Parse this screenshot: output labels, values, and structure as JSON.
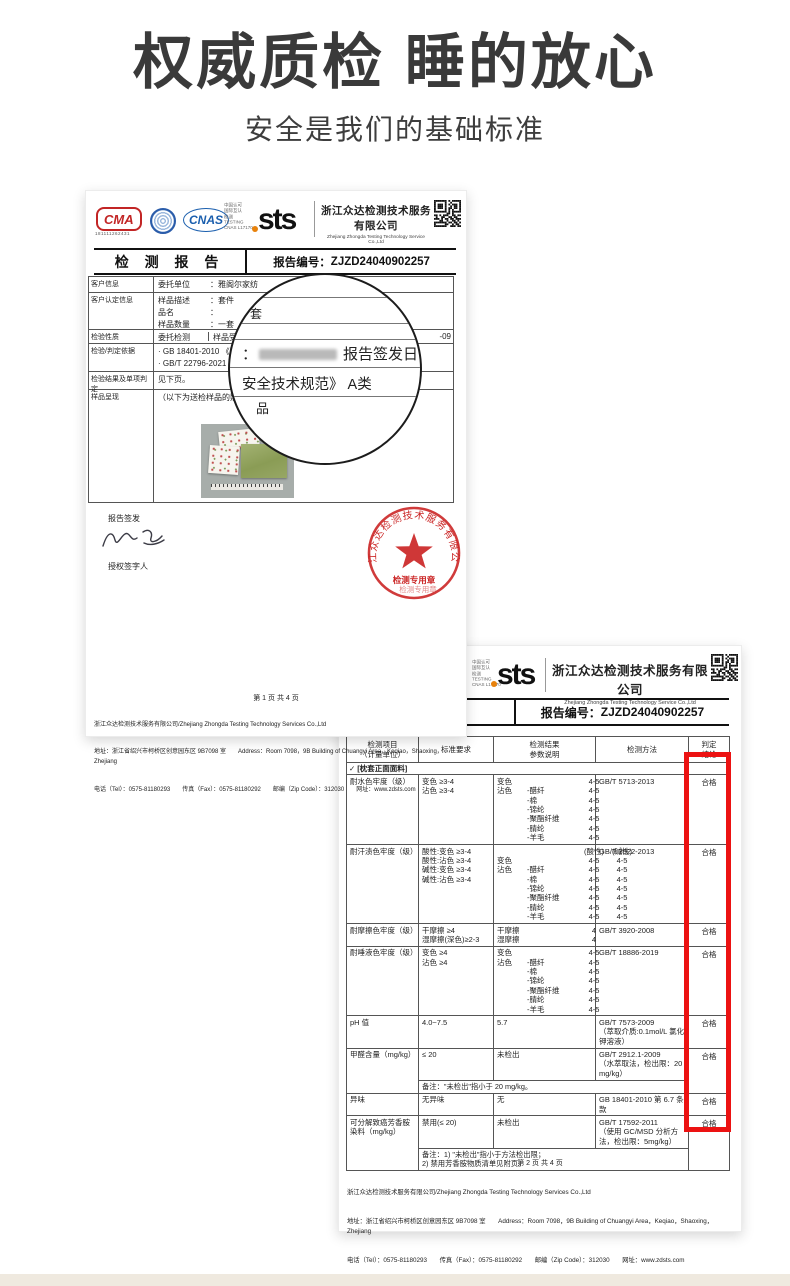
{
  "hero": {
    "title": "权威质检 睡的放心",
    "subtitle": "安全是我们的基础标准"
  },
  "logos": {
    "cma": "CMA",
    "cma_no": "181111262431",
    "ilac": "ilac-MRA",
    "cnas": "CNAS",
    "cnas_small": "中国认可\n国际互认\n检测\nTESTING\nCNAS L17170",
    "sts": "sts"
  },
  "company": {
    "name_cn": "浙江众达检测技术服务有限公司",
    "name_en": "Zhejiang Zhongda Testing Technology Service Co.,Ltd"
  },
  "footer": {
    "company": "浙江众达检测技术服务有限公司/Zhejiang Zhongda Testing Technology Services Co.,Ltd",
    "address": "地址：浙江省绍兴市柯桥区创意园东区 9B7098 室　　Address：Room 7098，9B Building of Chuangyi Area，Keqiao，Shaoxing，Zhejiang",
    "contact": "电话（Tel）：0575-81180293　　传真（Fax）：0575-81180292　　邮编（Zip Code）：312030　　网址：www.zdsts.com"
  },
  "report1": {
    "doc_title": "检 测 报 告",
    "report_no_label": "报告编号：",
    "report_no": "ZJZD24040902257",
    "info_rows": [
      {
        "label": "客户信息",
        "lines": [
          {
            "k": "委托单位",
            "v": "：雅阁尔家纺"
          }
        ]
      },
      {
        "label": "客户认定信息",
        "lines": [
          {
            "k": "样品描述",
            "v": "：套件"
          },
          {
            "k": "品名",
            "v": "："
          },
          {
            "k": "样品数量",
            "v": "：一套"
          }
        ]
      },
      {
        "label": "检验性质",
        "split": true,
        "lines": [
          {
            "k": "委托检测"
          },
          {
            "k": "样品受理/"
          }
        ],
        "tail": "-09"
      },
      {
        "label": "检验/判定依据",
        "lines": [
          {
            "k": "· GB 18401-2010 《国家"
          },
          {
            "k": "· GB/T 22796-2021 《床"
          }
        ]
      },
      {
        "label": "检验结果及单项判定",
        "lines": [
          {
            "k": "见下页。"
          }
        ]
      },
      {
        "label": "样品呈现",
        "lines": [
          {
            "k": "（以下为送检样品的照片呈现"
          }
        ]
      }
    ],
    "sign": {
      "issue": "报告签发",
      "signer": "授权签字人"
    },
    "stamp": {
      "ring": "浙江众达检测技术服务有限公司",
      "label": "检测专用章"
    },
    "page_no": "第 1 页 共 4 页"
  },
  "magnifier": {
    "top1": "件",
    "top2": "套",
    "colon": "：",
    "issue_label": "报告签发日",
    "line2": "安全技术规范》 A类",
    "partial": "品"
  },
  "report2": {
    "report_no_label": "报告编号：",
    "report_no": "ZJZD24040902257",
    "page_no": "第 2 页 共 4 页",
    "table": {
      "headers": [
        [
          "检测项目",
          "（计量单位）"
        ],
        [
          "标准要求"
        ],
        [
          "检测结果",
          "参数说明"
        ],
        [
          "检测方法"
        ],
        [
          "判定",
          "结论"
        ]
      ],
      "section": {
        "check": "✓",
        "label": "[枕套正面面料]"
      },
      "rows": [
        {
          "item": "耐水色牢度（级）",
          "req": [
            "变色 ≥3-4",
            "沾色 ≥3-4"
          ],
          "res": [
            {
              "l": "变色",
              "a": "4-5"
            },
            {
              "l": "沾色",
              "s": "-醋纤",
              "a": "4-5"
            },
            {
              "s": "-棉",
              "a": "4-5"
            },
            {
              "s": "-锦纶",
              "a": "4-5"
            },
            {
              "s": "-聚酯纤维",
              "a": "4-5"
            },
            {
              "s": "-腈纶",
              "a": "4-5"
            },
            {
              "s": "-羊毛",
              "a": "4-5"
            }
          ],
          "met": [
            "GB/T 5713-2013"
          ],
          "verdict": "合格"
        },
        {
          "item": "耐汗渍色牢度（级）",
          "req": [
            "酸性:变色 ≥3-4",
            "酸性:沾色 ≥3-4",
            "碱性:变色 ≥3-4",
            "碱性:沾色 ≥3-4"
          ],
          "res": [
            {
              "a": "(酸性)",
              "b": "(碱性)"
            },
            {
              "l": "变色",
              "a": "4-5",
              "b": "4-5"
            },
            {
              "l": "沾色",
              "s": "-醋纤",
              "a": "4-5",
              "b": "4-5"
            },
            {
              "s": "-棉",
              "a": "4-5",
              "b": "4-5"
            },
            {
              "s": "-锦纶",
              "a": "4-5",
              "b": "4-5"
            },
            {
              "s": "-聚酯纤维",
              "a": "4-5",
              "b": "4-5"
            },
            {
              "s": "-腈纶",
              "a": "4-5",
              "b": "4-5"
            },
            {
              "s": "-羊毛",
              "a": "4-5",
              "b": "4-5"
            }
          ],
          "met": [
            "GB/T 3922-2013"
          ],
          "verdict": "合格"
        },
        {
          "item": "耐摩擦色牢度（级）",
          "req": [
            "干摩擦 ≥4",
            "湿摩擦(深色)≥2-3"
          ],
          "res": [
            {
              "l": "干摩擦",
              "a": "4"
            },
            {
              "l": "湿摩擦",
              "a": "4"
            }
          ],
          "met": [
            "GB/T 3920-2008"
          ],
          "verdict": "合格"
        },
        {
          "item": "耐唾液色牢度（级）",
          "req": [
            "变色 ≥4",
            "沾色 ≥4"
          ],
          "res": [
            {
              "l": "变色",
              "a": "4-5"
            },
            {
              "l": "沾色",
              "s": "-醋纤",
              "a": "4-5"
            },
            {
              "s": "-棉",
              "a": "4-5"
            },
            {
              "s": "-锦纶",
              "a": "4-5"
            },
            {
              "s": "-聚酯纤维",
              "a": "4-5"
            },
            {
              "s": "-腈纶",
              "a": "4-5"
            },
            {
              "s": "-羊毛",
              "a": "4-5"
            }
          ],
          "met": [
            "GB/T 18886-2019"
          ],
          "verdict": "合格"
        },
        {
          "item": "pH 值",
          "req": [
            "4.0~7.5"
          ],
          "res": [
            {
              "l": "5.7"
            }
          ],
          "met": [
            "GB/T 7573-2009",
            "（萃取介质:0.1mol/L 氯化钾溶液）"
          ],
          "verdict": "合格"
        },
        {
          "item": "甲醛含量（mg/kg）",
          "req": [
            "≤ 20"
          ],
          "res": [
            {
              "l": "未检出"
            }
          ],
          "met": [
            "GB/T 2912.1-2009",
            "（水萃取法，检出限：20mg/kg）"
          ],
          "verdict": "合格",
          "note": [
            "备注：\"未检出\"指小于 20 mg/kg。"
          ]
        },
        {
          "item": "异味",
          "req": [
            "无异味"
          ],
          "res": [
            {
              "l": "无"
            }
          ],
          "met": [
            "GB 18401-2010 第 6.7 条款"
          ],
          "verdict": "合格"
        },
        {
          "item": "可分解致癌芳香胺染料（mg/kg）",
          "req": [
            "禁用(≤ 20)"
          ],
          "res": [
            {
              "l": "未检出"
            }
          ],
          "met": [
            "GB/T 17592-2011",
            "（使用 GC/MSD 分析方法，检出限：5mg/kg）"
          ],
          "verdict": "合格",
          "note": [
            "备注：1) \"未检出\"指小于方法检出限；",
            "2) 禁用芳香胺物质清单见附页。"
          ]
        }
      ]
    }
  }
}
